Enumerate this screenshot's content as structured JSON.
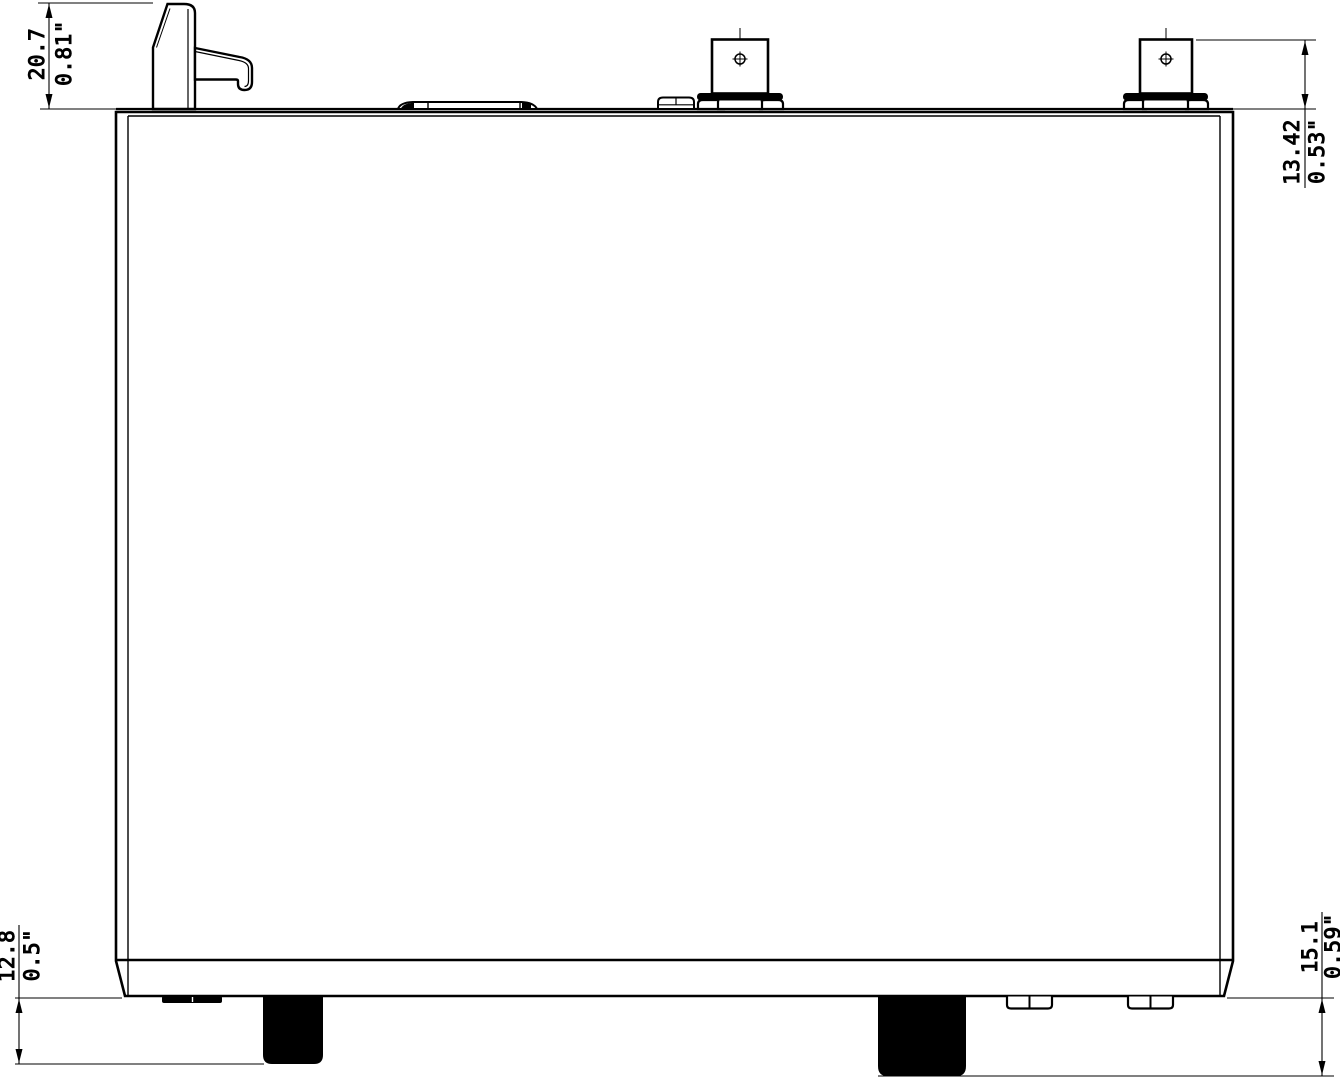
{
  "drawing": {
    "colors": {
      "line": "#000000",
      "background": "#ffffff",
      "foot_fill": "#000000"
    },
    "dims": {
      "latch": {
        "mm": "20.7",
        "in": "0.81\""
      },
      "antenna": {
        "mm": "13.42",
        "in": "0.53\""
      },
      "front_foot": {
        "mm": "12.8",
        "in": "0.5\""
      },
      "rear_foot": {
        "mm": "15.1",
        "in": "0.59\""
      }
    }
  }
}
